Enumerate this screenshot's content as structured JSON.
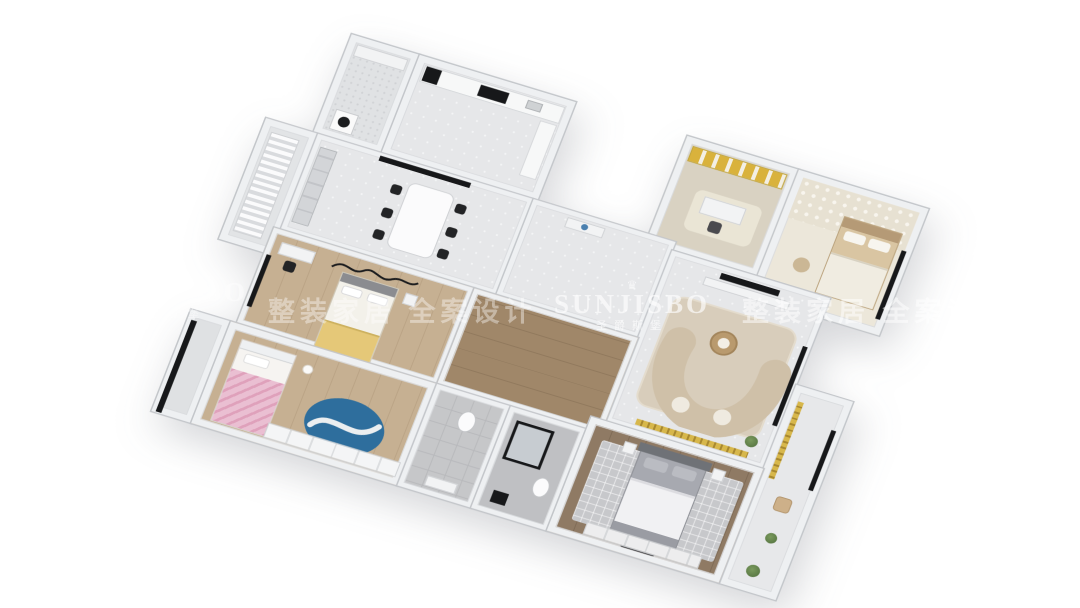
{
  "image_type": "3d-rendered apartment floor plan (axonometric top view)",
  "watermark": {
    "crown": "♛",
    "brand": "SUNJISBO",
    "brand_cn": "圣爵斯堡",
    "slogan_left": "整装家居 全案设计",
    "slogan_right": "整装家居 全案设计"
  },
  "rooms": [
    "utility balcony",
    "kitchen",
    "dining room",
    "west balcony",
    "entry corridor",
    "study",
    "guest bedroom",
    "living room",
    "east balcony",
    "second bedroom",
    "inner hallway",
    "kids bedroom",
    "kids balcony",
    "bathroom",
    "shower bathroom",
    "master bedroom"
  ],
  "palette": {
    "background": "#ffffff",
    "wall": "#eef0f2",
    "wall_edge": "#c3c6ca",
    "marble_floor": "#e6e7e9",
    "light_wood": "#c6b092",
    "dark_wood": "#8f7a64",
    "accent_gold": "#d7b74b",
    "kids_rug_blue": "#2e6e9d",
    "kids_bed_pink": "#eabfd2",
    "bed_blanket_yellow": "#e5c878",
    "master_bed_gray": "#a7a9b0",
    "sofa_beige": "#cfc0a8",
    "fixture_black": "#17181a"
  }
}
